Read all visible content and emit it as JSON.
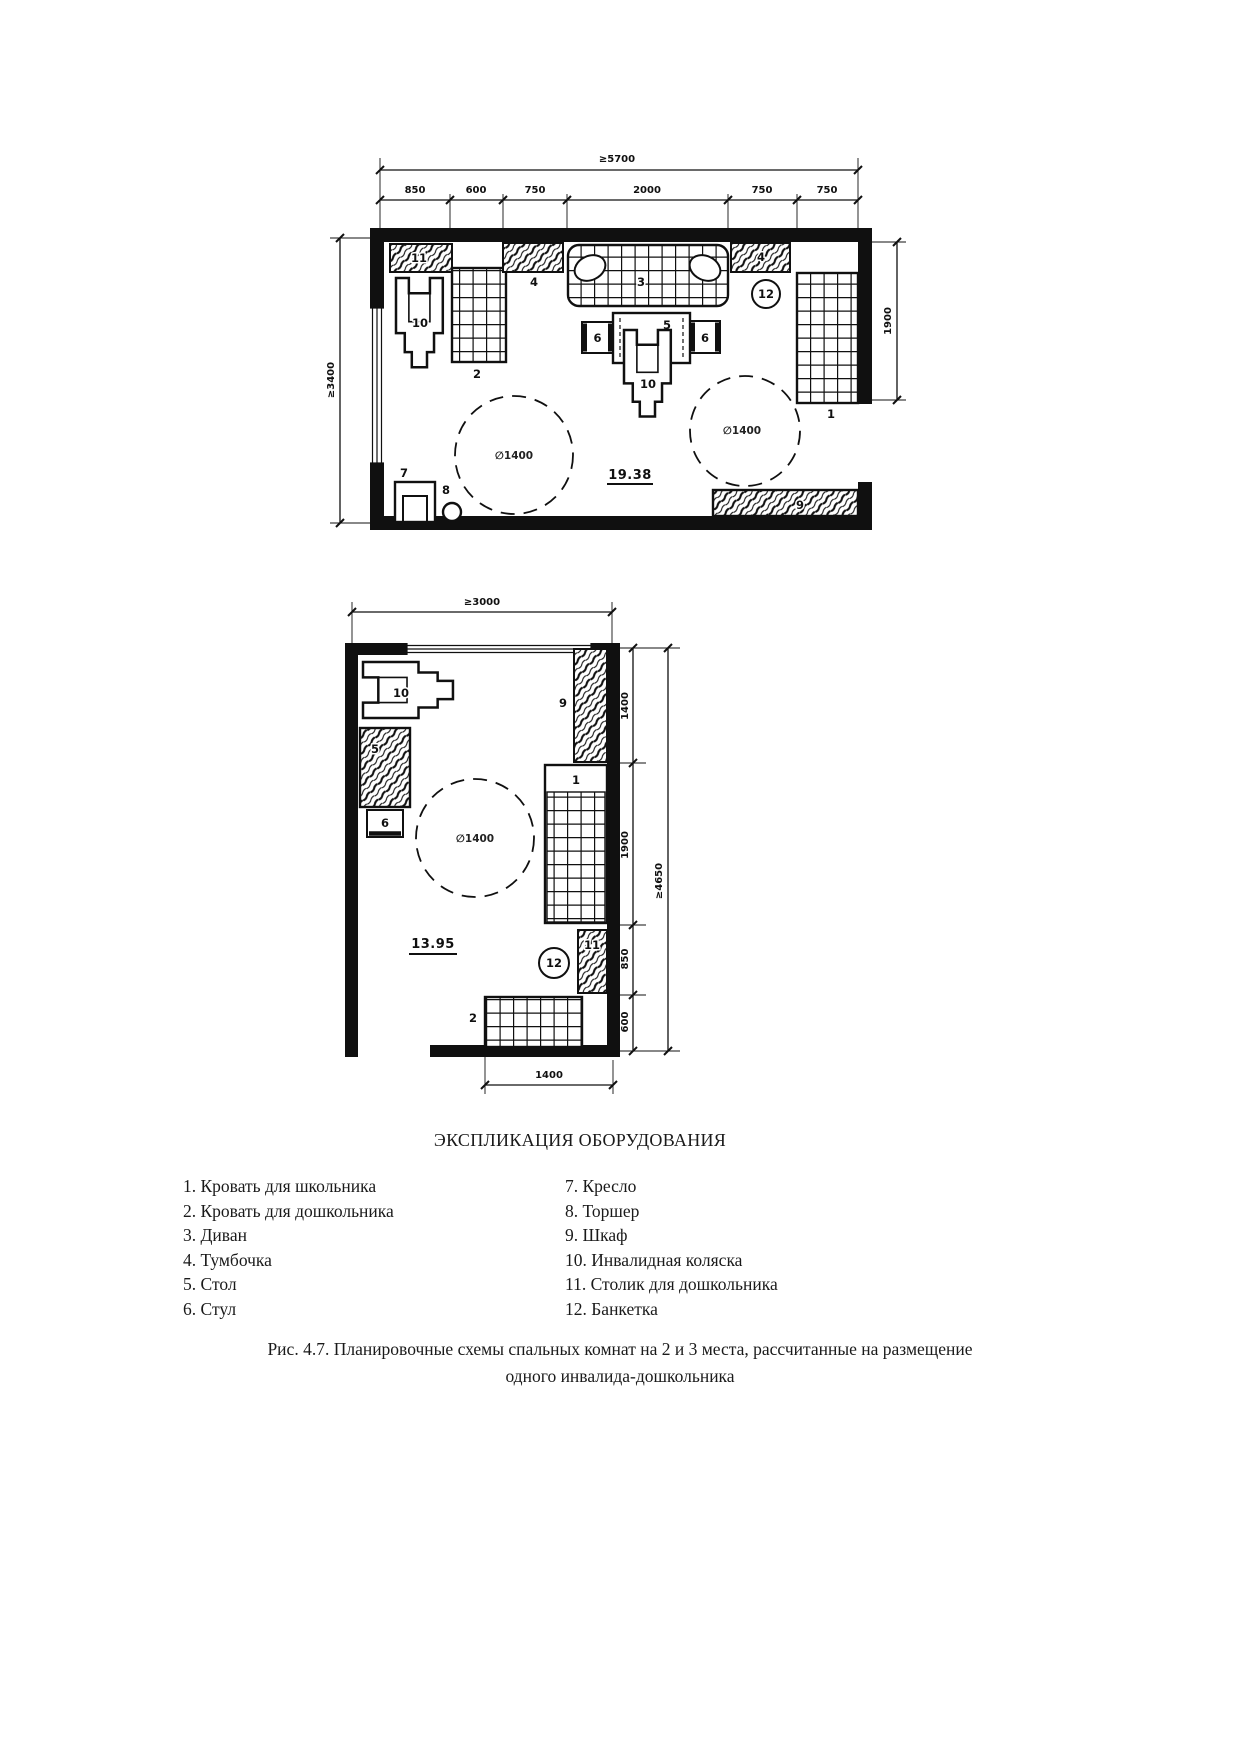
{
  "figure": {
    "legend_title": "ЭКСПЛИКАЦИЯ ОБОРУДОВАНИЯ",
    "caption_line1": "Рис. 4.7. Планировочные схемы спальных комнат на 2 и 3 места, рассчитанные на размещение",
    "caption_line2": "одного инвалида-дошкольника"
  },
  "legend": {
    "left": [
      "1. Кровать для школьника",
      "2. Кровать для дошкольника",
      "3. Диван",
      "4. Тумбочка",
      "5. Стол",
      "6. Стул"
    ],
    "right": [
      "7. Кресло",
      "8. Торшер",
      "9. Шкаф",
      "10. Инвалидная коляска",
      "11. Столик для дошкольника",
      "12. Банкетка"
    ]
  },
  "plan1": {
    "area": "19.38",
    "turning_circle": "∅1400",
    "dims": {
      "total_width": "≥5700",
      "top_segments": [
        "850",
        "600",
        "750",
        "2000",
        "750",
        "750"
      ],
      "left_height": "≥3400",
      "right_height": "1900"
    },
    "callouts": {
      "bed_school": "1",
      "bed_preschool": "2",
      "sofa": "3",
      "nightstand_left": "4",
      "nightstand_right": "4",
      "table": "5",
      "chair_left": "6",
      "chair_right": "6",
      "armchair": "7",
      "floor_lamp": "8",
      "wardrobe": "9",
      "wheelchair_left": "10",
      "wheelchair_center": "10",
      "kids_table": "11",
      "bench": "12"
    }
  },
  "plan2": {
    "area": "13.95",
    "turning_circle": "∅1400",
    "dims": {
      "total_width": "≥3000",
      "right_segments": [
        "1400",
        "1900",
        "850",
        "600"
      ],
      "right_total": "≥4650",
      "bottom_width": "1400"
    },
    "callouts": {
      "bed_school": "1",
      "bed_preschool": "2",
      "table": "5",
      "chair": "6",
      "wardrobe": "9",
      "wheelchair": "10",
      "kids_table": "11",
      "bench": "12"
    }
  }
}
